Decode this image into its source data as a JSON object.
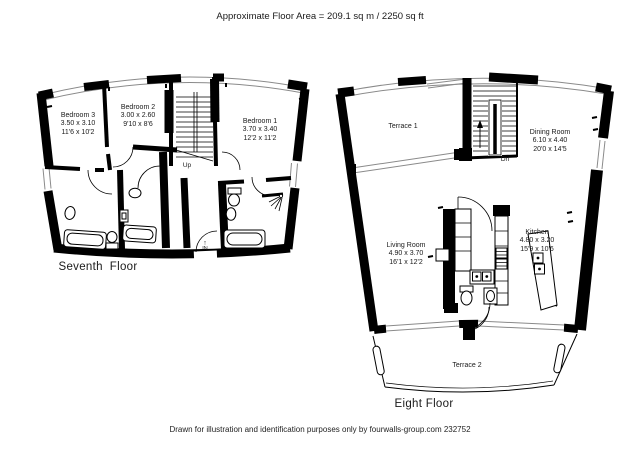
{
  "title": "Approximate Floor Area = 209.1 sq m / 2250 sq ft",
  "footer": "Drawn for illustration and identification purposes only by fourwalls-group.com 232752",
  "colors": {
    "wall": "#000000",
    "glazing": "#8a8a8a",
    "background": "#ffffff",
    "text": "#1a1a1a"
  },
  "floors": {
    "seventh": {
      "name": "Seventh  Floor",
      "stair_label": "Up",
      "entrance_label": "IN",
      "entrance_arrow": "↑",
      "rooms": [
        {
          "name": "Bedroom 3",
          "metric": "3.50 x 3.10",
          "imperial": "11'6 x 10'2"
        },
        {
          "name": "Bedroom 2",
          "metric": "3.00 x 2.60",
          "imperial": "9'10 x 8'6"
        },
        {
          "name": "Bedroom 1",
          "metric": "3.70 x 3.40",
          "imperial": "12'2 x 11'2"
        }
      ]
    },
    "eighth": {
      "name": "Eight Floor",
      "stair_label": "Dn",
      "rooms": [
        {
          "name": "Terrace 1"
        },
        {
          "name": "Dining Room",
          "metric": "6.10 x 4.40",
          "imperial": "20'0 x 14'5"
        },
        {
          "name": "Living Room",
          "metric": "4.90 x 3.70",
          "imperial": "16'1 x 12'2"
        },
        {
          "name": "Kitchen",
          "metric": "4.80 x 3.20",
          "imperial": "15'9 x 10'6"
        },
        {
          "name": "Terrace 2"
        }
      ]
    }
  }
}
